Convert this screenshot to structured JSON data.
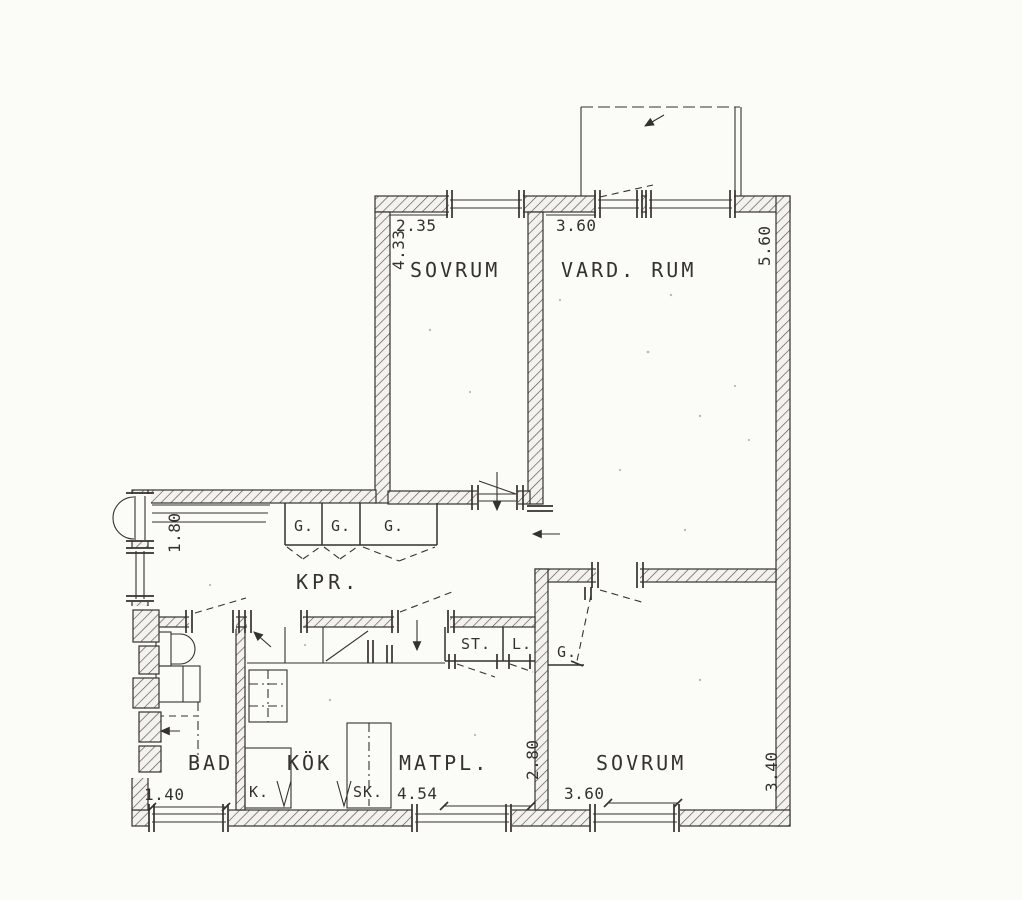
{
  "colors": {
    "ink": "#35322e",
    "paper": "#fbfbf8"
  },
  "rooms": {
    "sovrum_top": "SOVRUM",
    "vardagsrum": "VARD. RUM",
    "hall": "KPR.",
    "bad": "BAD",
    "kok": "KÖK",
    "matplats": "MATPL.",
    "sovrum_lower": "SOVRUM"
  },
  "closets": {
    "hall": [
      "G.",
      "G.",
      "G."
    ],
    "bedroom": "G.",
    "cleaning": "ST.",
    "linen": "L.",
    "fridge": "K.",
    "cabinet": "SK."
  },
  "dimensions_m": {
    "sovrum_top_width": "2.35",
    "sovrum_top_depth": "4.33",
    "vardagsrum_width": "3.60",
    "vardagsrum_depth": "5.60",
    "hall_entry": "1.80",
    "bad_width": "1.40",
    "kok_matplats_width": "4.54",
    "matplats_depth": "2.80",
    "sovrum_lower_width": "3.60",
    "sovrum_lower_depth": "3.40"
  }
}
